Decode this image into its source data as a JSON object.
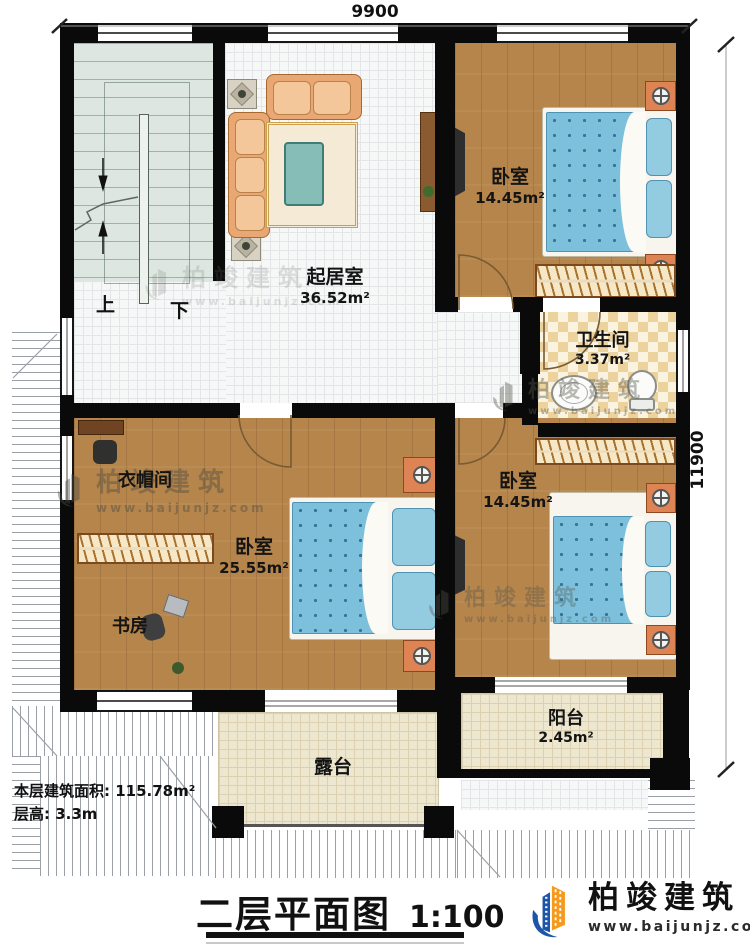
{
  "dimensions": {
    "width_top": "9900",
    "height_right": "11900"
  },
  "rooms": {
    "living": {
      "name": "起居室",
      "area": "36.52m²"
    },
    "bedroom_top": {
      "name": "卧室",
      "area": "14.45m²"
    },
    "bedroom_right": {
      "name": "卧室",
      "area": "14.45m²"
    },
    "bedroom_master": {
      "name": "卧室",
      "area": "25.55m²"
    },
    "bathroom": {
      "name": "卫生间",
      "area": "3.37m²"
    },
    "cloakroom": {
      "name": "衣帽间"
    },
    "study": {
      "name": "书房"
    },
    "balcony": {
      "name": "阳台",
      "area": "2.45m²"
    },
    "terrace": {
      "name": "露台"
    }
  },
  "stairs": {
    "up_label": "上",
    "down_label": "下"
  },
  "notes": {
    "floor_area": "本层建筑面积: 115.78m²",
    "floor_height": "层高: 3.3m"
  },
  "title": {
    "text": "二层平面图",
    "scale": "1:100"
  },
  "brand": {
    "name": "柏竣建筑",
    "url": "www.baijunjz.com"
  },
  "watermark": {
    "name": "柏竣建筑",
    "url": "www.baijunjz.com"
  },
  "colors": {
    "wall": "#0a0a0a",
    "wood_floor": "#b5854b",
    "mattress_blue": "#7cc0dc",
    "brand_blue": "#1d56a8",
    "brand_orange": "#f59a1d"
  }
}
